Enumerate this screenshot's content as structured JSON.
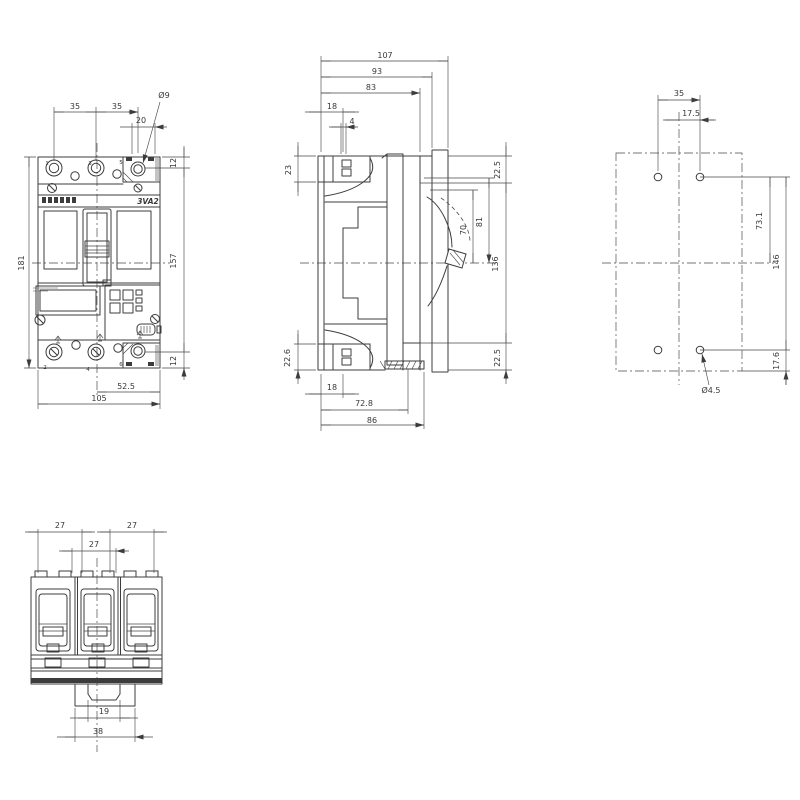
{
  "page": {
    "background": "#ffffff",
    "line_color": "#3c3c3c",
    "text_color": "#383838",
    "drawing_type": "dimension drawing, molded case circuit breaker"
  },
  "product": {
    "model_label": "3VA2",
    "brand_logo": "SIEMENS"
  },
  "views": {
    "front_view": {
      "dimensions_mm": [
        "35",
        "35",
        "Ø9",
        "20",
        "12",
        "157",
        "12",
        "181",
        "52.5",
        "105"
      ],
      "terminal_numbers": [
        "1",
        "3",
        "5",
        "2",
        "4",
        "6"
      ]
    },
    "side_view": {
      "dimensions_mm": [
        "107",
        "93",
        "83",
        "18",
        "4",
        "23",
        "22.5",
        "70",
        "81",
        "136",
        "22.6",
        "18",
        "72.8",
        "86",
        "22.5"
      ]
    },
    "drilling_plan": {
      "dimensions_mm": [
        "35",
        "17.5",
        "73.1",
        "146",
        "17.6",
        "Ø4.5"
      ]
    },
    "bottom_view": {
      "dimensions_mm": [
        "27",
        "27",
        "27",
        "19",
        "38"
      ]
    }
  },
  "labels": [
    {
      "id": "front-dim-35-left",
      "text": "35",
      "x": 75,
      "y": 109
    },
    {
      "id": "front-dim-35-right",
      "text": "35",
      "x": 117,
      "y": 109
    },
    {
      "id": "front-dim-dia9",
      "text": "Ø9",
      "x": 164,
      "y": 98
    },
    {
      "id": "front-dim-20",
      "text": "20",
      "x": 141,
      "y": 123
    },
    {
      "id": "front-dim-12-top",
      "text": "12",
      "x": 176,
      "y": 163,
      "r": -90
    },
    {
      "id": "front-dim-157",
      "text": "157",
      "x": 176,
      "y": 261,
      "r": -90
    },
    {
      "id": "front-dim-12-bottom",
      "text": "12",
      "x": 176,
      "y": 361,
      "r": -90
    },
    {
      "id": "front-dim-181",
      "text": "181",
      "x": 24,
      "y": 263,
      "r": -90
    },
    {
      "id": "front-dim-52-5",
      "text": "52.5",
      "x": 126,
      "y": 389
    },
    {
      "id": "front-dim-105",
      "text": "105",
      "x": 99,
      "y": 401
    },
    {
      "id": "terminal-no-1",
      "text": "1",
      "x": 47,
      "y": 165,
      "cls": "xs"
    },
    {
      "id": "terminal-no-3",
      "text": "3",
      "x": 90,
      "y": 165,
      "cls": "xs"
    },
    {
      "id": "terminal-no-5",
      "text": "5",
      "x": 121,
      "y": 164,
      "cls": "xs"
    },
    {
      "id": "terminal-no-2",
      "text": "2",
      "x": 45,
      "y": 369,
      "cls": "xs"
    },
    {
      "id": "terminal-no-4",
      "text": "4",
      "x": 88,
      "y": 371,
      "cls": "xs"
    },
    {
      "id": "terminal-no-6",
      "text": "6",
      "x": 121,
      "y": 366,
      "cls": "xs"
    },
    {
      "id": "model-label",
      "text": "3VA2",
      "x": 148,
      "y": 204,
      "cls": "model"
    },
    {
      "id": "side-dim-107",
      "text": "107",
      "x": 385,
      "y": 58
    },
    {
      "id": "side-dim-93",
      "text": "93",
      "x": 377,
      "y": 74
    },
    {
      "id": "side-dim-83",
      "text": "83",
      "x": 371,
      "y": 90
    },
    {
      "id": "side-dim-18-top",
      "text": "18",
      "x": 332,
      "y": 109
    },
    {
      "id": "side-dim-4",
      "text": "4",
      "x": 352,
      "y": 124
    },
    {
      "id": "side-dim-23",
      "text": "23",
      "x": 291,
      "y": 170,
      "r": -90
    },
    {
      "id": "side-dim-22-6",
      "text": "22.6",
      "x": 290,
      "y": 358,
      "r": -90
    },
    {
      "id": "side-dim-18-bottom",
      "text": "18",
      "x": 332,
      "y": 390
    },
    {
      "id": "side-dim-72-8",
      "text": "72.8",
      "x": 364,
      "y": 406
    },
    {
      "id": "side-dim-86",
      "text": "86",
      "x": 372,
      "y": 423
    },
    {
      "id": "side-dim-22-5-top",
      "text": "22.5",
      "x": 500,
      "y": 170,
      "r": -90
    },
    {
      "id": "side-dim-70",
      "text": "70",
      "x": 466,
      "y": 230,
      "r": -90
    },
    {
      "id": "side-dim-81",
      "text": "81",
      "x": 482,
      "y": 222,
      "r": -90
    },
    {
      "id": "side-dim-136",
      "text": "136",
      "x": 498,
      "y": 264,
      "r": -90
    },
    {
      "id": "side-dim-22-5-bottom",
      "text": "22.5",
      "x": 500,
      "y": 358,
      "r": -90
    },
    {
      "id": "drill-dim-35",
      "text": "35",
      "x": 679,
      "y": 96
    },
    {
      "id": "drill-dim-17-5",
      "text": "17.5",
      "x": 691,
      "y": 116
    },
    {
      "id": "drill-dim-73-1",
      "text": "73.1",
      "x": 762,
      "y": 221,
      "r": -90
    },
    {
      "id": "drill-dim-146",
      "text": "146",
      "x": 779,
      "y": 262,
      "r": -90
    },
    {
      "id": "drill-dim-17-6",
      "text": "17.6",
      "x": 779,
      "y": 361,
      "r": -90
    },
    {
      "id": "drill-dim-dia4-5",
      "text": "Ø4.5",
      "x": 711,
      "y": 393
    },
    {
      "id": "bottom-dim-27-left",
      "text": "27",
      "x": 60,
      "y": 528
    },
    {
      "id": "bottom-dim-27-right",
      "text": "27",
      "x": 132,
      "y": 528
    },
    {
      "id": "bottom-dim-27-mid",
      "text": "27",
      "x": 94,
      "y": 547
    },
    {
      "id": "bottom-dim-19",
      "text": "19",
      "x": 104,
      "y": 714
    },
    {
      "id": "bottom-dim-38",
      "text": "38",
      "x": 98,
      "y": 734
    }
  ]
}
